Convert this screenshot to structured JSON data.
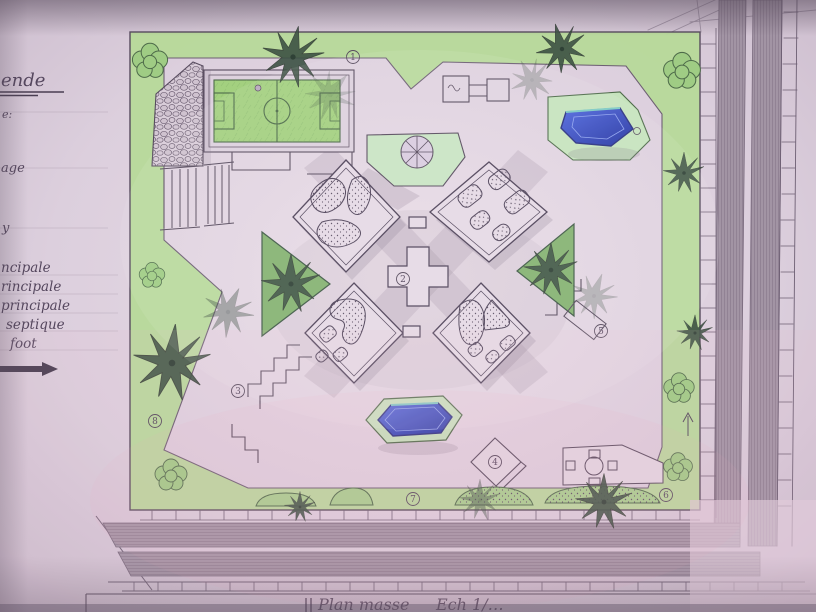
{
  "legend": {
    "heading": "ende",
    "items": [
      "e:",
      "age",
      "y",
      "ncipale",
      "rincipale",
      "principale",
      "septique",
      "foot"
    ]
  },
  "title_block": {
    "title": "Plan masse",
    "scale": "Ech 1/…"
  },
  "markers": [
    {
      "label": "1"
    },
    {
      "label": "2"
    },
    {
      "label": "3"
    },
    {
      "label": "4"
    },
    {
      "label": "5"
    },
    {
      "label": "6"
    },
    {
      "label": "7"
    },
    {
      "label": "8"
    }
  ],
  "colors": {
    "pool_blue": "#3b57d4",
    "lawn_green": "#b7d99a",
    "pitch_green": "#a3d07f",
    "palm_dark_green": "#3d5244",
    "paper_mauve": "#dccfdd",
    "graphite": "#6d5f73",
    "asphalt": "#a294a4"
  }
}
